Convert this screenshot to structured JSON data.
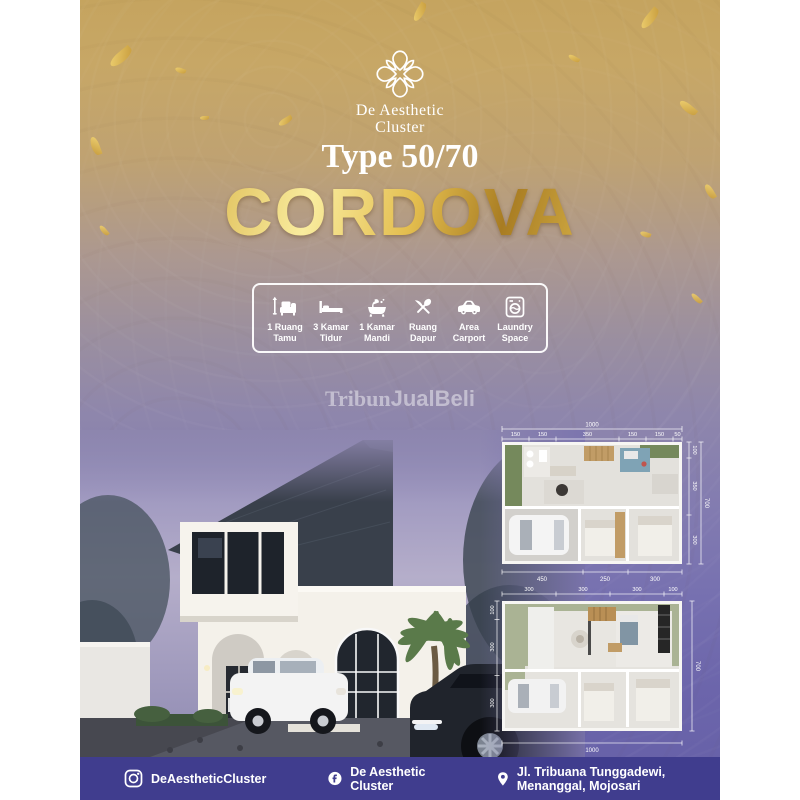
{
  "brand": {
    "name_line1": "De Aesthetic",
    "name_line2": "Cluster"
  },
  "header": {
    "type_label": "Type 50/70",
    "title": "CORDOVA"
  },
  "features": [
    {
      "icon": "sofa-icon",
      "line1": "1 Ruang",
      "line2": "Tamu"
    },
    {
      "icon": "bed-icon",
      "line1": "3 Kamar",
      "line2": "Tidur"
    },
    {
      "icon": "bathtub-icon",
      "line1": "1 Kamar",
      "line2": "Mandi"
    },
    {
      "icon": "cutlery-icon",
      "line1": "Ruang",
      "line2": "Dapur"
    },
    {
      "icon": "car-icon",
      "line1": "Area",
      "line2": "Carport"
    },
    {
      "icon": "washer-icon",
      "line1": "Laundry",
      "line2": "Space"
    }
  ],
  "watermark": {
    "part1": "Tribun",
    "part2": "JualBeli"
  },
  "floorplans": {
    "plan1": {
      "top_total": "1000",
      "top_segments": [
        "150",
        "150",
        "350",
        "150",
        "150",
        "50"
      ],
      "right_segments": [
        "100",
        "350",
        "300"
      ],
      "right_total": "700",
      "bottom_segments": [
        "450",
        "250",
        "300"
      ]
    },
    "plan2": {
      "top_segments": [
        "300",
        "300",
        "300",
        "100"
      ],
      "left_segments": [
        "100",
        "300",
        "300"
      ],
      "right_total": "700",
      "bottom_total": "1000"
    }
  },
  "footer": {
    "instagram_handle": "DeAestheticCluster",
    "facebook_name": "De Aesthetic Cluster",
    "address": "Jl. Tribuana Tunggadewi, Menanggal, Mojosari"
  },
  "colors": {
    "gold_top": "#c5a45f",
    "purple_bottom": "#6560a7",
    "footer_bar": "#403d8e",
    "gold_text": "#d9b44a",
    "roof": "#39404b"
  }
}
